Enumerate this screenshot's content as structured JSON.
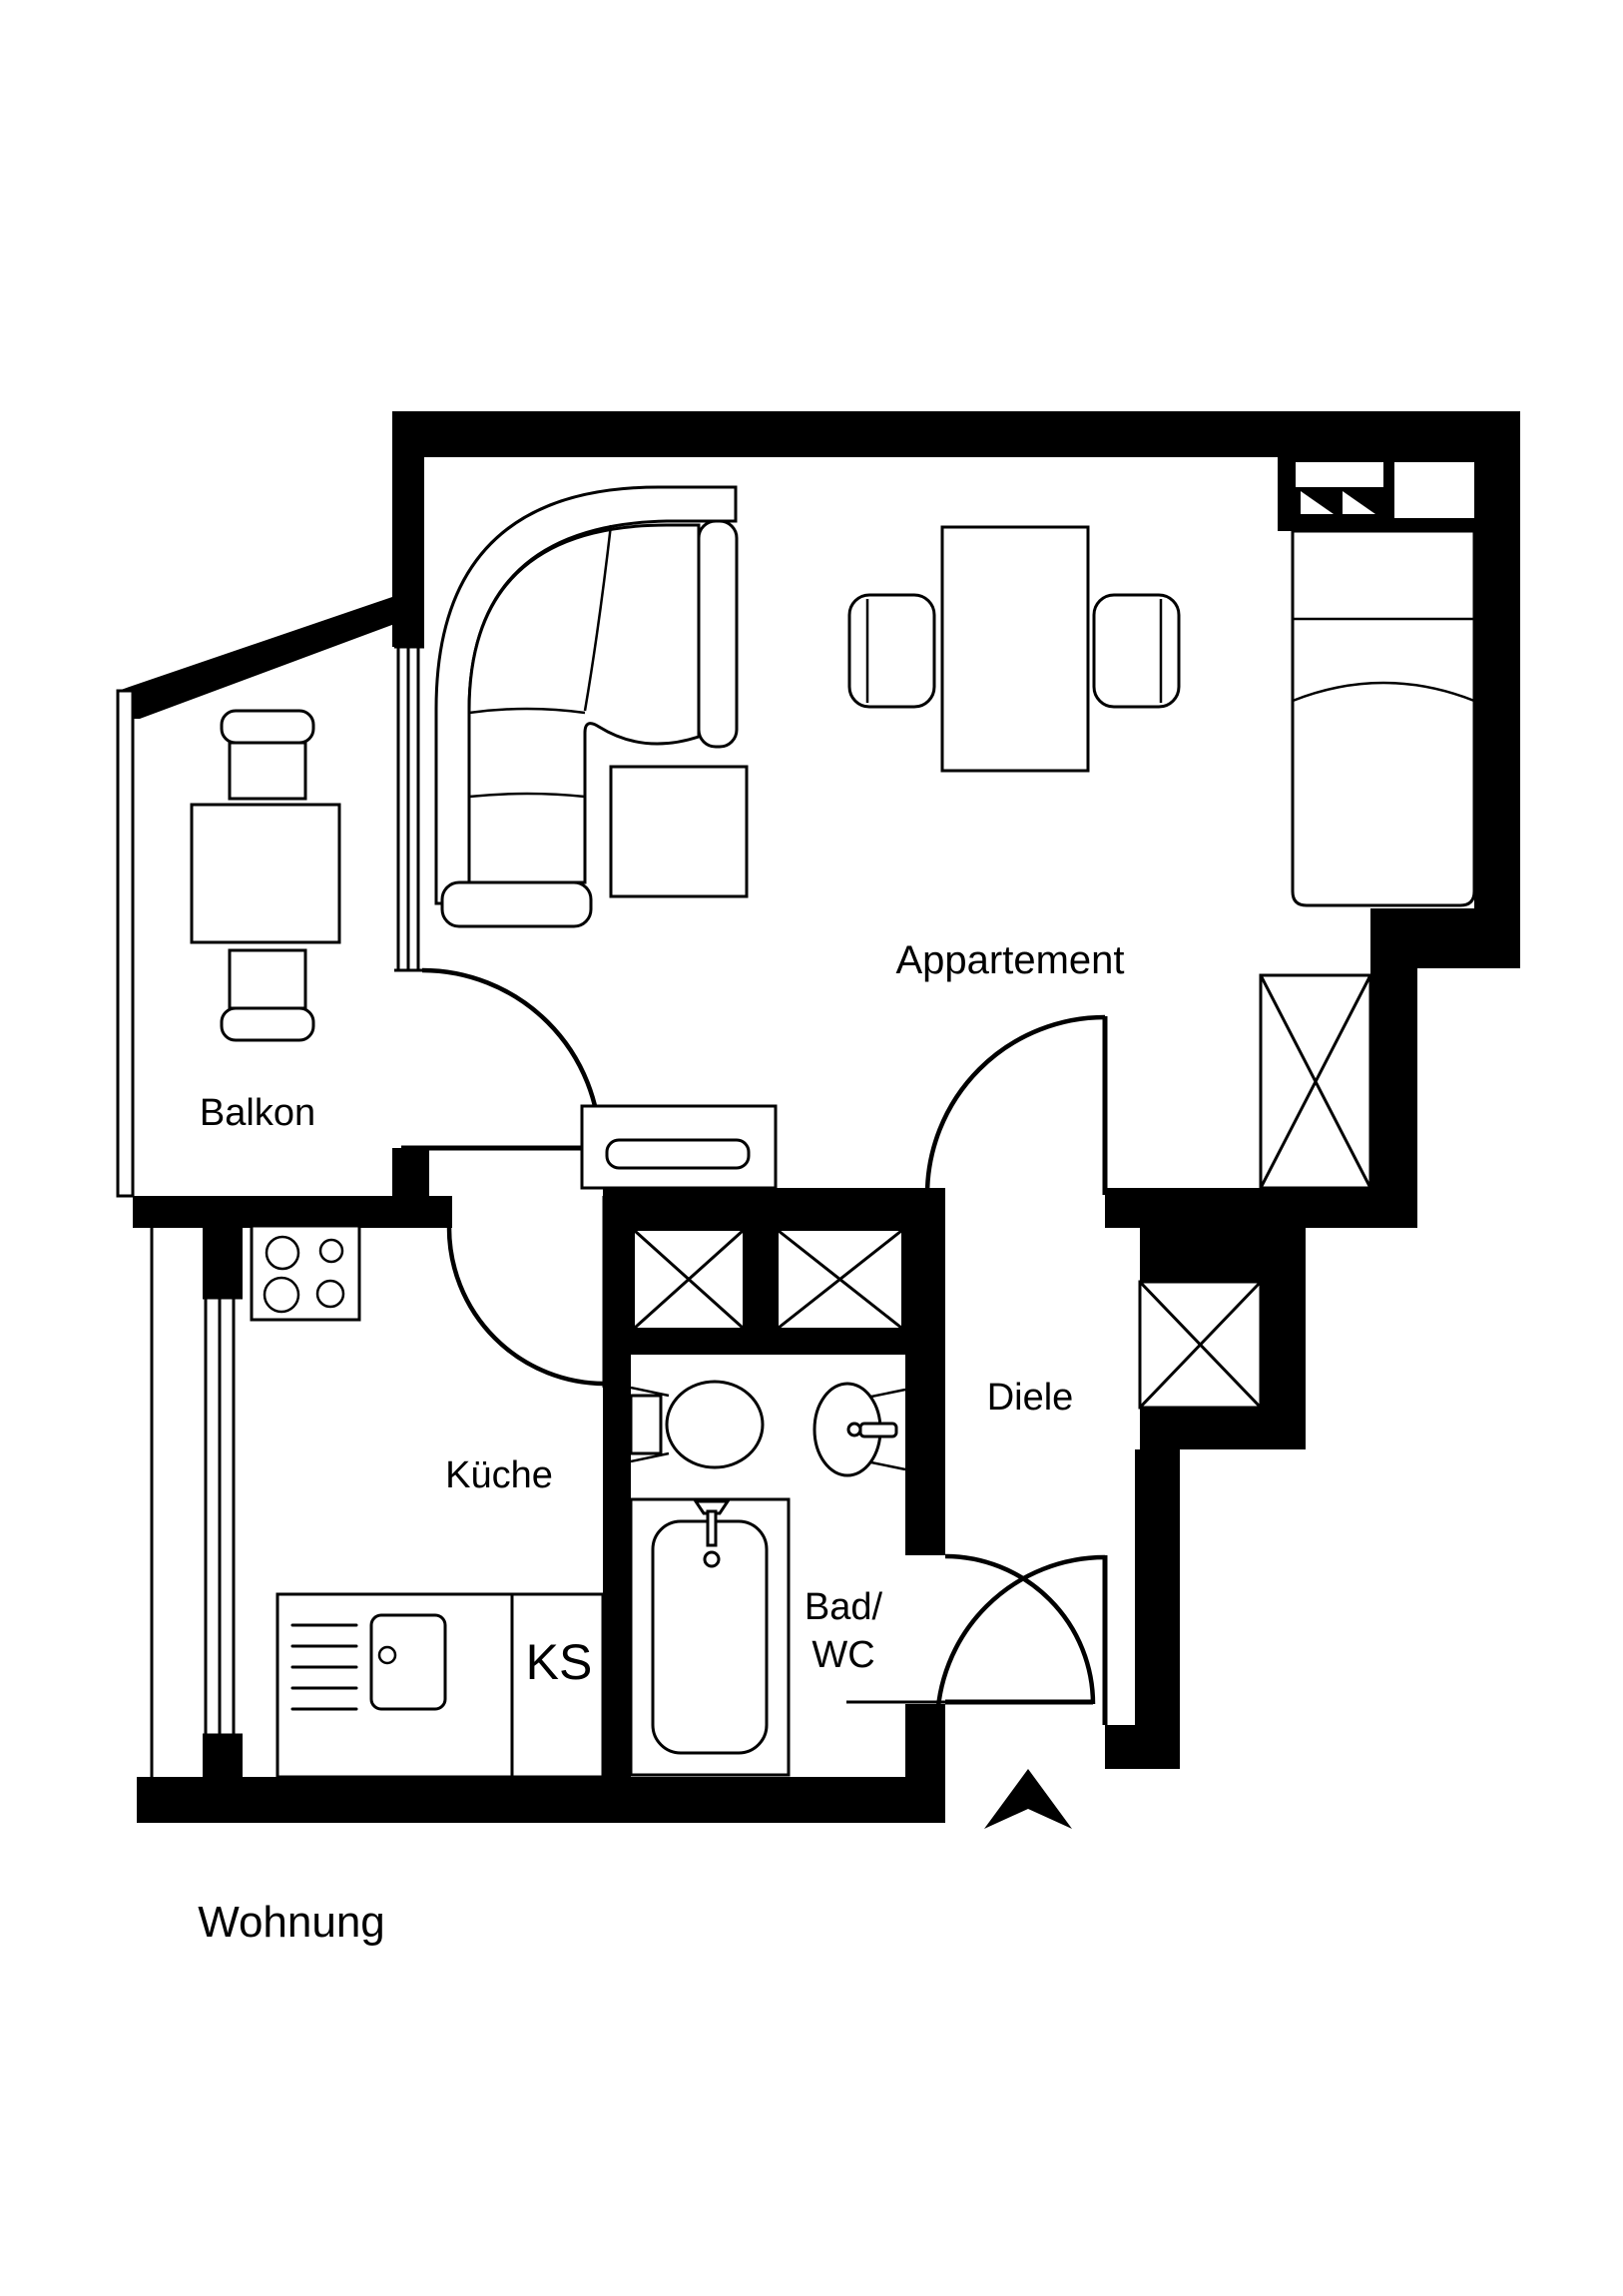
{
  "plan_title": "Wohnung",
  "colors": {
    "ink": "#000000",
    "paper": "#ffffff"
  },
  "rooms": {
    "appartement": {
      "label": "Appartement"
    },
    "balkon": {
      "label": "Balkon"
    },
    "kueche": {
      "label": "Küche"
    },
    "diele": {
      "label": "Diele"
    },
    "bad_wc": {
      "label_line1": "Bad/",
      "label_line2": "WC"
    },
    "ks": {
      "label": "KS"
    }
  }
}
